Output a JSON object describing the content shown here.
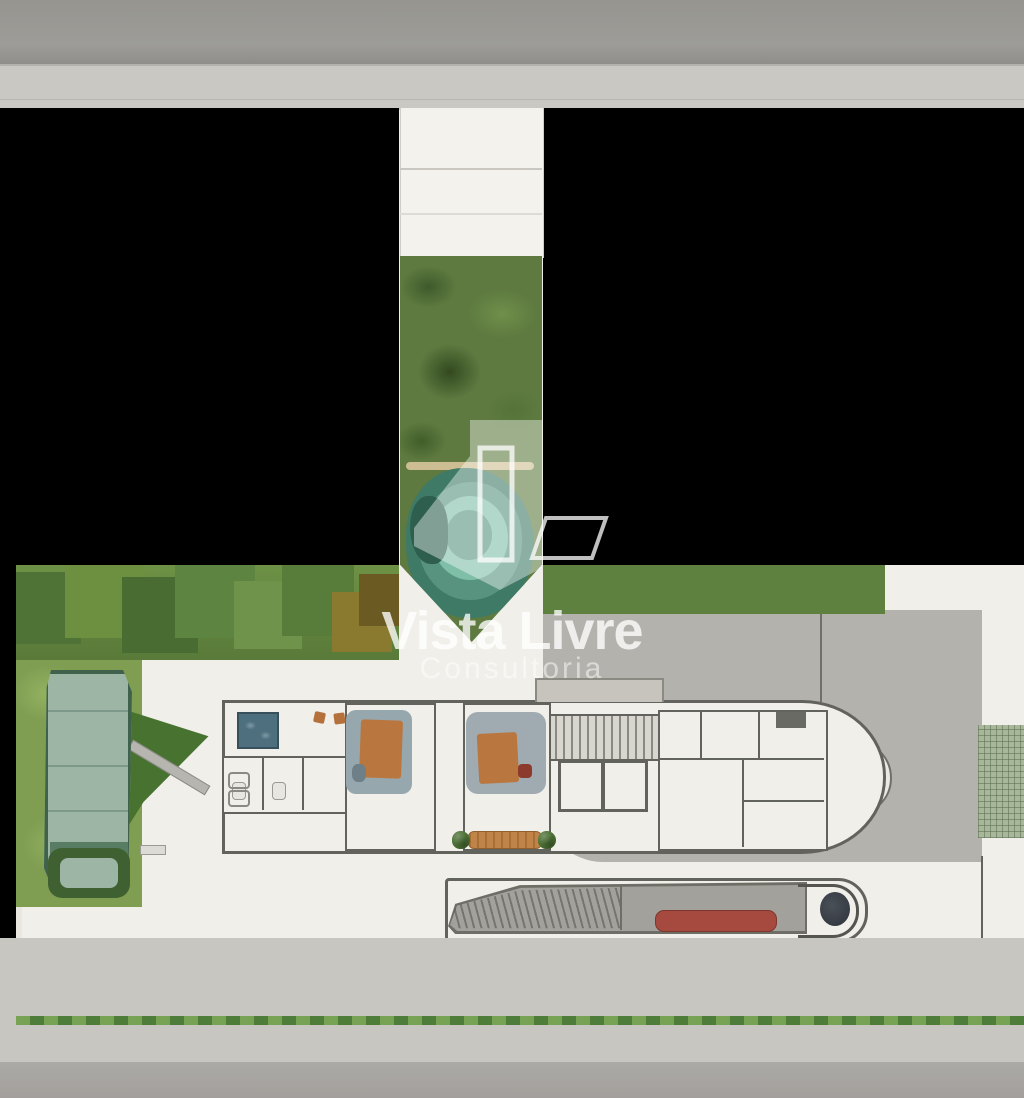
{
  "watermark": {
    "brand": "Vista Livre",
    "subtitle": "Consultoria"
  },
  "palette": {
    "redaction_teal": "#2b534c",
    "street_top_gray": "#9b9a96",
    "sidewalk_gray": "#cac8c2",
    "masked_black": "#000000",
    "paving_white": "#f0efe9",
    "driveway_gray": "#b4b2ad",
    "wall_gray": "#63635e",
    "lawn_green": "#7f9e52",
    "vegetation_green": "#5e7a40",
    "lagoon_teal": "#4e8f7c",
    "pool_water": "#9db5a5",
    "street_bottom_gray": "#a7a5a1",
    "bench_red": "#a64a3f",
    "seat_blue": "#2c4866",
    "furniture_orange": "#b5713c",
    "spa_blue": "#4e6f7d",
    "grid_pavers_green": "#a8b69a"
  },
  "markers": {
    "color": "#2b534c",
    "items": [
      {
        "x": 462,
        "y": 207,
        "w": 28,
        "h": 25
      },
      {
        "x": 463,
        "y": 386,
        "w": 26,
        "h": 24
      },
      {
        "x": 489,
        "y": 586,
        "w": 26,
        "h": 21
      },
      {
        "x": 128,
        "y": 671,
        "w": 27,
        "h": 22
      },
      {
        "x": 190,
        "y": 726,
        "w": 26,
        "h": 22
      },
      {
        "x": 287,
        "y": 723,
        "w": 26,
        "h": 24
      },
      {
        "x": 62,
        "y": 793,
        "w": 26,
        "h": 22
      },
      {
        "x": 369,
        "y": 782,
        "w": 26,
        "h": 23
      },
      {
        "x": 489,
        "y": 723,
        "w": 26,
        "h": 24
      },
      {
        "x": 677,
        "y": 804,
        "w": 26,
        "h": 23
      },
      {
        "x": 178,
        "y": 843,
        "w": 27,
        "h": 24
      },
      {
        "x": 336,
        "y": 842,
        "w": 27,
        "h": 25
      },
      {
        "x": 788,
        "y": 892,
        "w": 27,
        "h": 25
      }
    ]
  },
  "street_trees": [
    {
      "x": 25,
      "y": 1012,
      "r": 48,
      "c": "#b3a65a"
    },
    {
      "x": 110,
      "y": 1016,
      "r": 50,
      "c": "#a8a355"
    },
    {
      "x": 192,
      "y": 1015,
      "r": 48,
      "c": "#46673a"
    },
    {
      "x": 273,
      "y": 1016,
      "r": 46,
      "c": "#7d8344"
    },
    {
      "x": 355,
      "y": 1015,
      "r": 48,
      "c": "#3f5e35"
    },
    {
      "x": 480,
      "y": 1014,
      "r": 44,
      "c": "#8f8f4c"
    },
    {
      "x": 592,
      "y": 1016,
      "r": 48,
      "c": "#4b6e3e"
    },
    {
      "x": 805,
      "y": 1014,
      "r": 50,
      "c": "#6f8a3f"
    },
    {
      "x": 992,
      "y": 1015,
      "r": 46,
      "c": "#5d7f45"
    }
  ],
  "hedge_top_left": [
    {
      "x": 45,
      "y": 608,
      "r": 36,
      "c": "#4f7336"
    },
    {
      "x": 105,
      "y": 598,
      "r": 40,
      "c": "#6d9040"
    },
    {
      "x": 160,
      "y": 615,
      "r": 38,
      "c": "#486c32"
    },
    {
      "x": 215,
      "y": 598,
      "r": 40,
      "c": "#5d8440"
    },
    {
      "x": 268,
      "y": 615,
      "r": 34,
      "c": "#6f934a"
    },
    {
      "x": 318,
      "y": 600,
      "r": 36,
      "c": "#587c3a"
    },
    {
      "x": 362,
      "y": 622,
      "r": 30,
      "c": "#8a7a30"
    },
    {
      "x": 385,
      "y": 600,
      "r": 26,
      "c": "#6b5a22"
    }
  ],
  "hedge_top_right": [
    {
      "x": 560,
      "y": 588,
      "r": 26,
      "c": "#4c7038"
    },
    {
      "x": 605,
      "y": 592,
      "r": 28,
      "c": "#55793c"
    },
    {
      "x": 650,
      "y": 585,
      "r": 25,
      "c": "#3f6130"
    },
    {
      "x": 695,
      "y": 592,
      "r": 28,
      "c": "#567a3e"
    },
    {
      "x": 742,
      "y": 586,
      "r": 26,
      "c": "#496c36"
    },
    {
      "x": 788,
      "y": 592,
      "r": 27,
      "c": "#557a3e"
    },
    {
      "x": 832,
      "y": 587,
      "r": 25,
      "c": "#4c7038"
    },
    {
      "x": 865,
      "y": 592,
      "r": 22,
      "c": "#42642f"
    }
  ],
  "corner_trees": [
    {
      "x": 895,
      "y": 600,
      "r": 42,
      "c": "#4a6b35"
    },
    {
      "x": 955,
      "y": 588,
      "r": 38,
      "c": "#5c7d3b"
    },
    {
      "x": 1008,
      "y": 615,
      "r": 40,
      "c": "#466633"
    },
    {
      "x": 925,
      "y": 655,
      "r": 42,
      "c": "#54763c"
    },
    {
      "x": 985,
      "y": 675,
      "r": 38,
      "c": "#5f813f"
    },
    {
      "x": 940,
      "y": 705,
      "r": 33,
      "c": "#49682f"
    },
    {
      "x": 1012,
      "y": 692,
      "r": 30,
      "c": "#6b592a"
    }
  ],
  "right_bushes": [
    {
      "x": 985,
      "y": 845,
      "r": 26,
      "c": "#4d7034"
    },
    {
      "x": 1012,
      "y": 868,
      "r": 22,
      "c": "#426329"
    }
  ],
  "hedge_bottom": [
    {
      "x": 40,
      "y": 915,
      "r": 26,
      "c": "#3c5c2e"
    },
    {
      "x": 85,
      "y": 921,
      "r": 28,
      "c": "#486a36"
    },
    {
      "x": 130,
      "y": 912,
      "r": 25,
      "c": "#547740"
    },
    {
      "x": 175,
      "y": 922,
      "r": 27,
      "c": "#3f602f"
    },
    {
      "x": 222,
      "y": 914,
      "r": 26,
      "c": "#4d7039"
    },
    {
      "x": 266,
      "y": 921,
      "r": 27,
      "c": "#41632f"
    },
    {
      "x": 310,
      "y": 914,
      "r": 24,
      "c": "#567a41"
    },
    {
      "x": 352,
      "y": 922,
      "r": 24,
      "c": "#3a5829"
    },
    {
      "x": 392,
      "y": 916,
      "r": 22,
      "c": "#2f4b22"
    },
    {
      "x": 425,
      "y": 924,
      "r": 19,
      "c": "#35522a"
    }
  ],
  "amenities": {
    "loungers_top": [
      {
        "x": 96,
        "y": 664
      },
      {
        "x": 119,
        "y": 669
      },
      {
        "x": 142,
        "y": 674
      },
      {
        "x": 165,
        "y": 679
      }
    ],
    "loungers_mid": [
      {
        "x": 146,
        "y": 800
      },
      {
        "x": 164,
        "y": 812
      },
      {
        "x": 182,
        "y": 824
      },
      {
        "x": 200,
        "y": 836
      }
    ],
    "bar_chairs": [
      {
        "x": 141,
        "y": 747
      },
      {
        "x": 152,
        "y": 758
      },
      {
        "x": 163,
        "y": 769
      },
      {
        "x": 196,
        "y": 772
      },
      {
        "x": 207,
        "y": 783
      },
      {
        "x": 178,
        "y": 792
      }
    ],
    "bench_seat_count": 5
  }
}
